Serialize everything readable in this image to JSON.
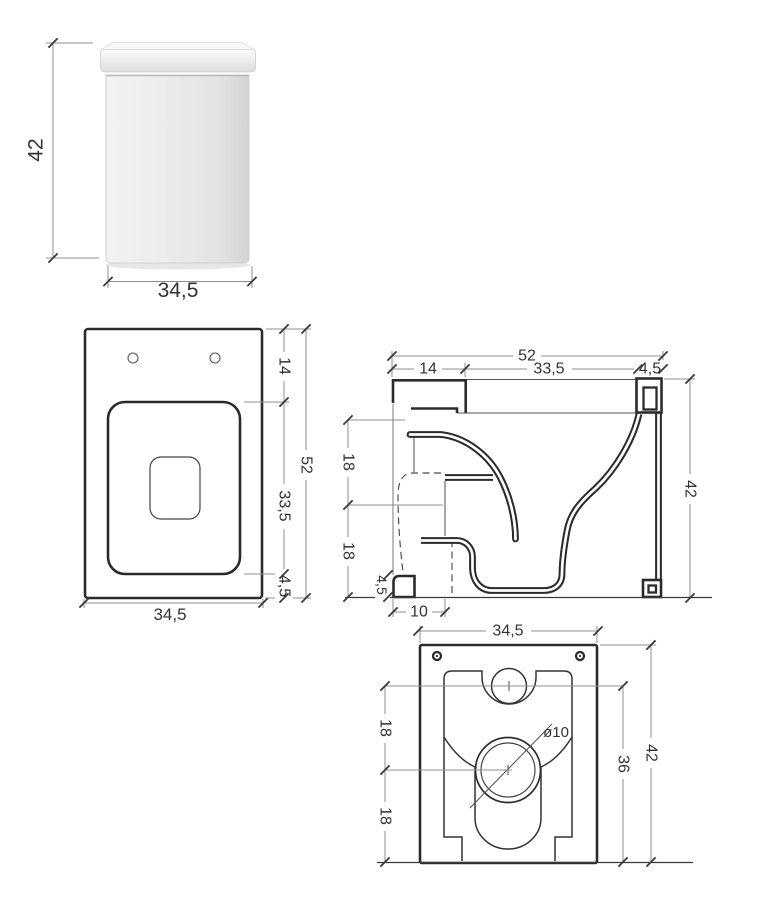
{
  "views": {
    "render": {
      "height": "42",
      "width": "34,5"
    },
    "plan": {
      "back_offset": "14",
      "total_depth": "52",
      "opening_depth": "33,5",
      "front_edge": "4,5",
      "width": "34,5"
    },
    "section": {
      "total_depth": "52",
      "back_channel": "14",
      "opening_depth": "33,5",
      "back_wall": "4,5",
      "height": "42",
      "upper_spacing": "18",
      "lower_spacing": "18",
      "foot_height": "4,5",
      "foot_depth": "10"
    },
    "rear": {
      "width": "34,5",
      "upper_spacing": "18",
      "lower_spacing": "18",
      "outlet_diameter": "ø10",
      "inlet_height": "36",
      "height": "42"
    }
  },
  "colors": {
    "line": "#2b2b2b",
    "dim_line": "#8f8f8f",
    "text": "#333333",
    "background": "#ffffff",
    "render_body": "#e8e8e8"
  }
}
